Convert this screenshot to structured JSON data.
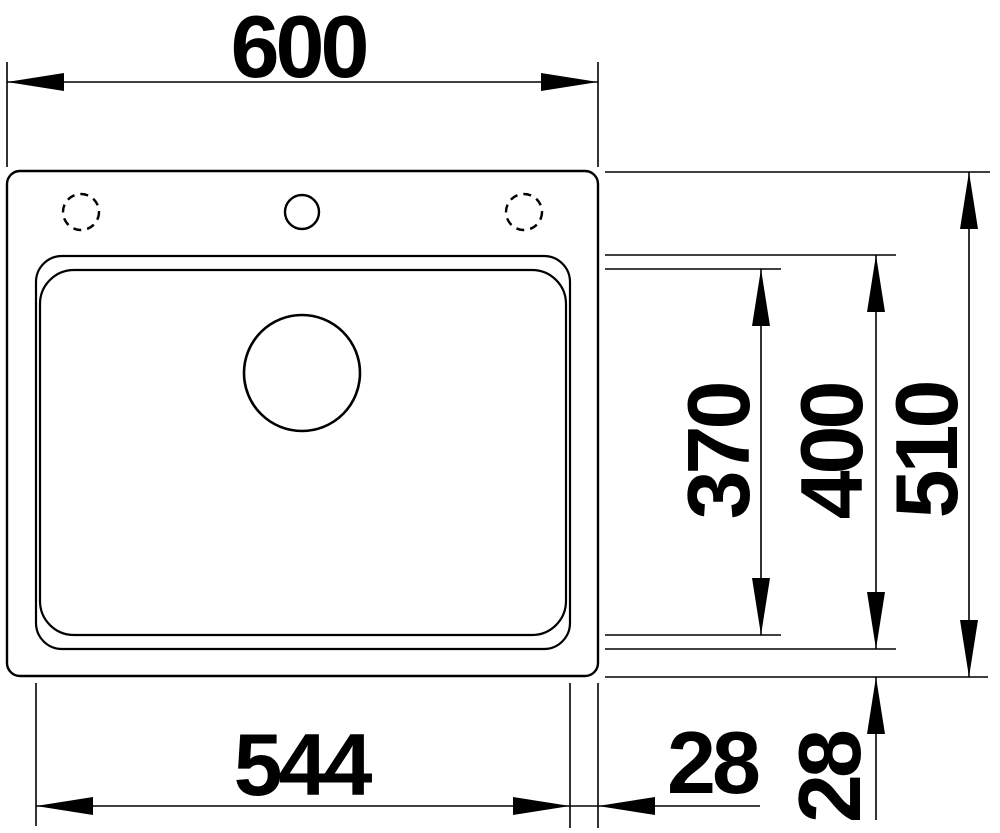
{
  "dimensions": {
    "top_width": "600",
    "overall_depth": "510",
    "bowl_outer_depth": "400",
    "bowl_inner_depth": "370",
    "bowl_width": "544",
    "rim_right": "28",
    "rim_bottom": "28"
  },
  "colors": {
    "line": "#000000",
    "background": "#ffffff"
  }
}
